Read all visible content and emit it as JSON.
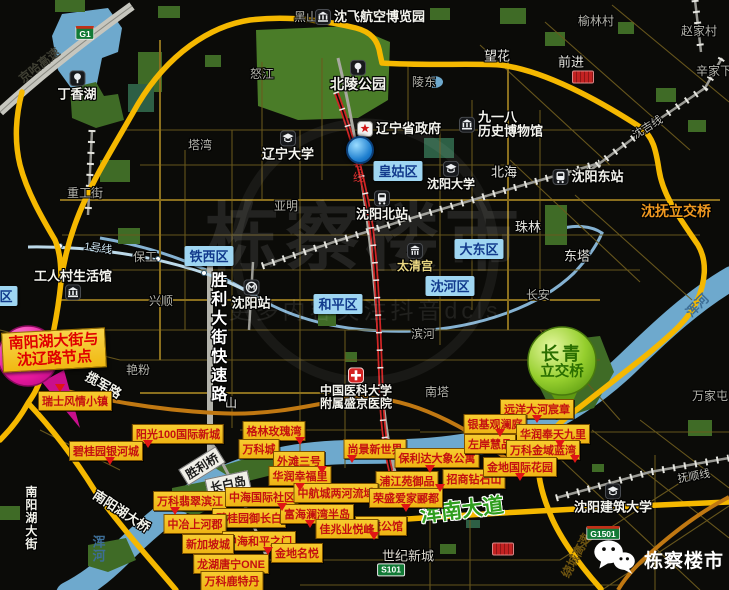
{
  "watermark": {
    "brand": "栋察楼市",
    "tagline": "更多内容关注抖音dcls"
  },
  "wechat": {
    "label": "栋察楼市"
  },
  "callouts": {
    "pink": {
      "line1": "南阳湖大街与",
      "line2": "沈辽路节点"
    },
    "green": {
      "line1": "长青",
      "line2": "立交桥"
    }
  },
  "districts": [
    {
      "label": "皇姑区",
      "x": 398,
      "y": 171
    },
    {
      "label": "铁西区",
      "x": 209,
      "y": 256
    },
    {
      "label": "大东区",
      "x": 479,
      "y": 249
    },
    {
      "label": "沈河区",
      "x": 450,
      "y": 286
    },
    {
      "label": "和平区",
      "x": 338,
      "y": 304
    },
    {
      "label": "区",
      "x": 6,
      "y": 296
    }
  ],
  "streets": [
    {
      "label": "黑山",
      "x": 306,
      "y": 18
    },
    {
      "label": "怒江",
      "x": 262,
      "y": 75
    },
    {
      "label": "塔湾",
      "x": 200,
      "y": 146
    },
    {
      "label": "重工街",
      "x": 85,
      "y": 194
    },
    {
      "label": "亚明",
      "x": 286,
      "y": 207
    },
    {
      "label": "保工",
      "x": 145,
      "y": 258
    },
    {
      "label": "兴顺",
      "x": 161,
      "y": 302
    },
    {
      "label": "艳粉",
      "x": 138,
      "y": 371
    },
    {
      "label": "陵东",
      "x": 424,
      "y": 83
    },
    {
      "label": "望花",
      "x": 497,
      "y": 57,
      "color": "#e8e8e2",
      "size": 13
    },
    {
      "label": "前进",
      "x": 571,
      "y": 63,
      "color": "#e8e8e2",
      "size": 13
    },
    {
      "label": "榆林村",
      "x": 596,
      "y": 22
    },
    {
      "label": "赵家村",
      "x": 699,
      "y": 32
    },
    {
      "label": "辛家下",
      "x": 714,
      "y": 72
    },
    {
      "label": "北海",
      "x": 504,
      "y": 173,
      "color": "#e8e8e2",
      "size": 13
    },
    {
      "label": "珠林",
      "x": 528,
      "y": 228,
      "color": "#e8e8e2",
      "size": 13
    },
    {
      "label": "东塔",
      "x": 577,
      "y": 257,
      "color": "#e8e8e2",
      "size": 13
    },
    {
      "label": "长安",
      "x": 538,
      "y": 296
    },
    {
      "label": "滨河",
      "x": 423,
      "y": 335
    },
    {
      "label": "南塔",
      "x": 437,
      "y": 393
    },
    {
      "label": "万家屯",
      "x": 710,
      "y": 397
    },
    {
      "label": "世纪新城",
      "x": 408,
      "y": 557,
      "color": "#dedad0",
      "size": 13
    },
    {
      "label": "山",
      "x": 231,
      "y": 404,
      "color": "#e8e8e2"
    }
  ],
  "road_labels": [
    {
      "label": "京哈高速",
      "x": 40,
      "y": 66,
      "rot": -38,
      "color": "#3f3f33",
      "size": 12,
      "bold": true,
      "outline": "none"
    },
    {
      "label": "1号线",
      "x": 98,
      "y": 249,
      "rot": 8,
      "color": "#cfe6f2",
      "size": 11
    },
    {
      "label": "2号线",
      "x": 357,
      "y": 168,
      "vertical": true,
      "color": "#e03030",
      "size": 11,
      "outline": "none"
    },
    {
      "label": "胜利大街快速路",
      "x": 216,
      "y": 338,
      "vertical": true,
      "color": "#ffffff",
      "size": 16,
      "bold": true,
      "spac": 3
    },
    {
      "label": "揽军路",
      "x": 103,
      "y": 386,
      "rot": 30,
      "color": "#f2f2ea",
      "size": 13,
      "bold": true
    },
    {
      "label": "南阳湖大桥",
      "x": 121,
      "y": 512,
      "rot": 33,
      "color": "#f2f2ea",
      "size": 13,
      "bold": true
    },
    {
      "label": "南阳湖大街",
      "x": 30,
      "y": 518,
      "vertical": true,
      "color": "#f2f2ea",
      "size": 12,
      "bold": true
    },
    {
      "label": "浑南大道",
      "x": 462,
      "y": 511,
      "rot": -7,
      "color": "#2f9e1e",
      "size": 21,
      "bold": true,
      "outline": "light"
    },
    {
      "label": "沈抚立交桥",
      "x": 676,
      "y": 211,
      "color": "#ef9820",
      "size": 14,
      "bold": true
    },
    {
      "label": "沈吉线",
      "x": 648,
      "y": 128,
      "rot": -32,
      "color": "#c4c4bc",
      "size": 11
    },
    {
      "label": "抚顺线",
      "x": 694,
      "y": 477,
      "rot": -10,
      "color": "#c4c4bc",
      "size": 11
    },
    {
      "label": "绕城高速",
      "x": 577,
      "y": 556,
      "rot": -62,
      "color": "#6e5410",
      "size": 12,
      "bold": true,
      "outline": "none"
    },
    {
      "label": "浑河",
      "x": 97,
      "y": 549,
      "vertical": true,
      "color": "#3d6e96",
      "size": 13,
      "bold": true,
      "outline": "none"
    },
    {
      "label": "浑河",
      "x": 698,
      "y": 306,
      "rot": -45,
      "color": "#3d6e96",
      "size": 13,
      "bold": true,
      "outline": "none"
    }
  ],
  "pois": [
    {
      "label": "丁香湖",
      "x": 77,
      "y": 86,
      "icon": "park",
      "layout": "col",
      "size": 13
    },
    {
      "label": "北陵公园",
      "x": 358,
      "y": 76,
      "icon": "park",
      "layout": "col",
      "size": 14
    },
    {
      "label": "沈飞航空博览园",
      "x": 370,
      "y": 17,
      "icon": "museum",
      "layout": "row",
      "size": 13
    },
    {
      "label": "辽宁省政府",
      "x": 399,
      "y": 129,
      "icon": "gov",
      "layout": "row",
      "size": 13
    },
    {
      "lines": [
        "九一八",
        "历史博物馆"
      ],
      "x": 501,
      "y": 125,
      "icon": "museum",
      "layout": "row",
      "size": 13
    },
    {
      "label": "辽宁大学",
      "x": 288,
      "y": 146,
      "icon": "school",
      "layout": "col",
      "size": 13
    },
    {
      "label": "沈阳大学",
      "x": 451,
      "y": 176,
      "icon": "school",
      "layout": "col",
      "size": 12
    },
    {
      "label": "沈阳北站",
      "x": 382,
      "y": 206,
      "icon": "train",
      "layout": "col",
      "size": 13
    },
    {
      "label": "沈阳东站",
      "x": 588,
      "y": 177,
      "icon": "train",
      "layout": "row",
      "size": 13
    },
    {
      "label": "沈阳站",
      "x": 251,
      "y": 295,
      "icon": "metro",
      "layout": "col",
      "size": 13
    },
    {
      "label": "工人村生活馆",
      "x": 73,
      "y": 285,
      "icon": "museum",
      "layout": "col-rev",
      "size": 13
    },
    {
      "label": "太清宫",
      "x": 415,
      "y": 258,
      "icon": "temple",
      "layout": "col",
      "size": 12,
      "color": "#ead883"
    },
    {
      "lines": [
        "中国医科大学",
        "附属盛京医院"
      ],
      "x": 356,
      "y": 389,
      "icon": "hospital",
      "layout": "col",
      "size": 12
    },
    {
      "label": "沈阳建筑大学",
      "x": 613,
      "y": 499,
      "icon": "school",
      "layout": "col",
      "size": 13
    }
  ],
  "projects": [
    {
      "label": "瑞士风情小镇",
      "x": 75,
      "y": 401
    },
    {
      "label": "阳光100国际新城",
      "x": 178,
      "y": 434
    },
    {
      "label": "碧桂园银河城",
      "x": 106,
      "y": 451
    },
    {
      "label": "格林玫瑰湾",
      "x": 274,
      "y": 431
    },
    {
      "label": "万科城",
      "x": 259,
      "y": 449
    },
    {
      "label": "外滩三号",
      "x": 299,
      "y": 461
    },
    {
      "label": "华润幸福里",
      "x": 300,
      "y": 476
    },
    {
      "label": "尚景新世界",
      "x": 375,
      "y": 449
    },
    {
      "label": "保利达大象公寓",
      "x": 437,
      "y": 458
    },
    {
      "label": "浦江苑御品",
      "x": 407,
      "y": 481
    },
    {
      "label": "招商钻石山",
      "x": 474,
      "y": 479
    },
    {
      "label": "远洋大河宸章",
      "x": 537,
      "y": 409
    },
    {
      "label": "银基观澜庭",
      "x": 495,
      "y": 424
    },
    {
      "label": "华润奉天九里",
      "x": 553,
      "y": 434
    },
    {
      "label": "左岸慧品",
      "x": 490,
      "y": 444
    },
    {
      "label": "万科金域蓝湾",
      "x": 543,
      "y": 450
    },
    {
      "label": "金地国际花园",
      "x": 520,
      "y": 467
    },
    {
      "label": "万科翡翠滨江",
      "x": 190,
      "y": 501
    },
    {
      "label": "中海国际社区",
      "x": 262,
      "y": 497
    },
    {
      "label": "中航城两河流域",
      "x": 336,
      "y": 493
    },
    {
      "label": "荣盛爱家郦都",
      "x": 406,
      "y": 498
    },
    {
      "label": "碧桂园御长白",
      "x": 249,
      "y": 518
    },
    {
      "label": "富海澜湾半岛",
      "x": 317,
      "y": 514
    },
    {
      "label": "中冶上河郡",
      "x": 195,
      "y": 524
    },
    {
      "label": "名流公馆",
      "x": 381,
      "y": 526
    },
    {
      "label": "佳兆业悦峰",
      "x": 347,
      "y": 529
    },
    {
      "label": "中海和平之门",
      "x": 259,
      "y": 541
    },
    {
      "label": "新加坡城",
      "x": 208,
      "y": 544
    },
    {
      "label": "金地名悦",
      "x": 297,
      "y": 553
    },
    {
      "label": "龙湖唐宁ONE",
      "x": 231,
      "y": 564
    },
    {
      "label": "万科鹿特丹",
      "x": 232,
      "y": 581
    }
  ],
  "white_boxes": [
    {
      "label": "胜利桥",
      "x": 202,
      "y": 466,
      "rot": -32
    },
    {
      "label": "长白岛",
      "x": 228,
      "y": 484,
      "rot": -12
    }
  ],
  "badges": [
    {
      "label": "G1",
      "x": 85,
      "y": 33,
      "type": "expwy"
    },
    {
      "label": "G1501",
      "x": 603,
      "y": 533,
      "type": "expwy"
    },
    {
      "label": "S101",
      "x": 391,
      "y": 570,
      "type": "prov"
    },
    {
      "label": "",
      "x": 583,
      "y": 77,
      "type": "red"
    },
    {
      "label": "",
      "x": 503,
      "y": 549,
      "type": "red"
    }
  ],
  "pointers": [
    {
      "x": 60,
      "y": 388
    },
    {
      "x": 148,
      "y": 444
    },
    {
      "x": 110,
      "y": 461
    },
    {
      "x": 175,
      "y": 511
    },
    {
      "x": 282,
      "y": 507
    },
    {
      "x": 310,
      "y": 524
    },
    {
      "x": 268,
      "y": 551
    },
    {
      "x": 352,
      "y": 459
    },
    {
      "x": 300,
      "y": 441
    },
    {
      "x": 322,
      "y": 470
    },
    {
      "x": 300,
      "y": 487
    },
    {
      "x": 430,
      "y": 469
    },
    {
      "x": 440,
      "y": 488
    },
    {
      "x": 537,
      "y": 419
    },
    {
      "x": 500,
      "y": 433
    },
    {
      "x": 560,
      "y": 444
    },
    {
      "x": 575,
      "y": 459
    },
    {
      "x": 520,
      "y": 477
    },
    {
      "x": 406,
      "y": 508
    },
    {
      "x": 374,
      "y": 536
    }
  ],
  "markers": [
    {
      "x": 360,
      "y": 150
    }
  ]
}
